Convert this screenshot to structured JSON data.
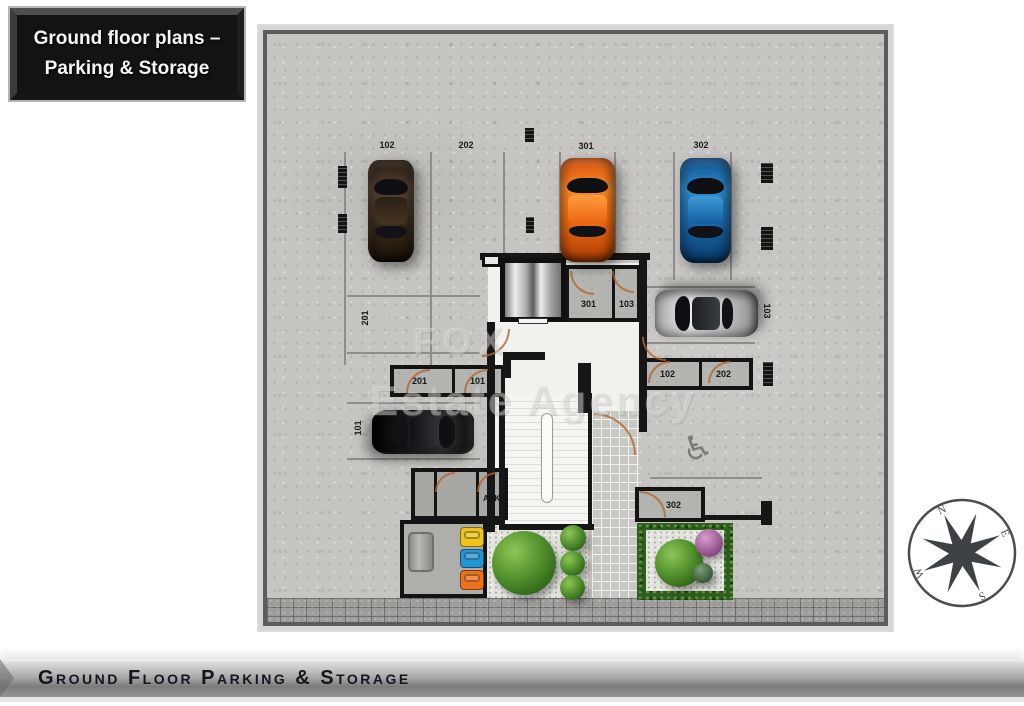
{
  "title_box": {
    "line1": "Ground floor plans –",
    "line2": "Parking & Storage"
  },
  "footer": {
    "label": "Ground Floor Parking & Storage"
  },
  "watermark": {
    "line1": "FOX",
    "line2": "Estate Agency"
  },
  "compass": {
    "north": "N",
    "east": "E",
    "south": "S",
    "west": "W"
  },
  "plan": {
    "parking_stalls": {
      "spot_102": "102",
      "spot_202": "202",
      "spot_301": "301",
      "spot_302": "302",
      "spot_201": "201",
      "spot_101": "101",
      "spot_103": "103"
    },
    "storage_rooms": {
      "room_201": "201",
      "room_101": "101",
      "room_301": "301",
      "room_103": "103",
      "room_102": "102",
      "room_202": "202",
      "room_302": "302",
      "room_ahk": "AHK"
    },
    "cars": [
      {
        "spot": "102",
        "color": "dark-brown",
        "hex": "#3c2d1e"
      },
      {
        "spot": "301",
        "color": "orange",
        "hex": "#f26d12"
      },
      {
        "spot": "302",
        "color": "blue",
        "hex": "#1a6cb0"
      },
      {
        "spot": "103",
        "color": "silver",
        "hex": "#cfcfcf"
      },
      {
        "spot": "101",
        "color": "black",
        "hex": "#1d1d1f"
      }
    ],
    "disabled_symbol": "♿"
  },
  "colors": {
    "plaque_bg": "#131313",
    "footer_text": "#15151f",
    "concrete": "#c6c5c2",
    "hedge_green": "#2e5e1d",
    "bin_yellow": "#f0c417",
    "bin_blue": "#2196d6",
    "bin_orange": "#f07018"
  }
}
